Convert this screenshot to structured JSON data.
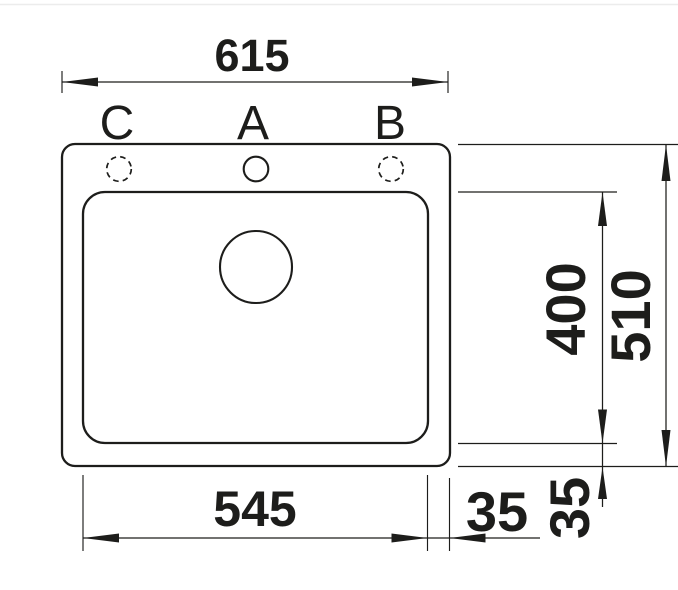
{
  "meta": {
    "description": "Technical dimension drawing, top view of an inset single-bowl kitchen sink"
  },
  "drawing": {
    "background_color": "#ffffff",
    "line_color": "#1d1d1b",
    "top_rule_color": "#ececec",
    "hole_labels": {
      "c": "C",
      "a": "A",
      "b": "B"
    },
    "dims": {
      "overall_width_mm": "615",
      "overall_depth_mm": "510",
      "bowl_width_mm": "545",
      "bowl_depth_mm": "400",
      "bottom_offset_mm": "35",
      "right_offset_mm": "35"
    }
  }
}
